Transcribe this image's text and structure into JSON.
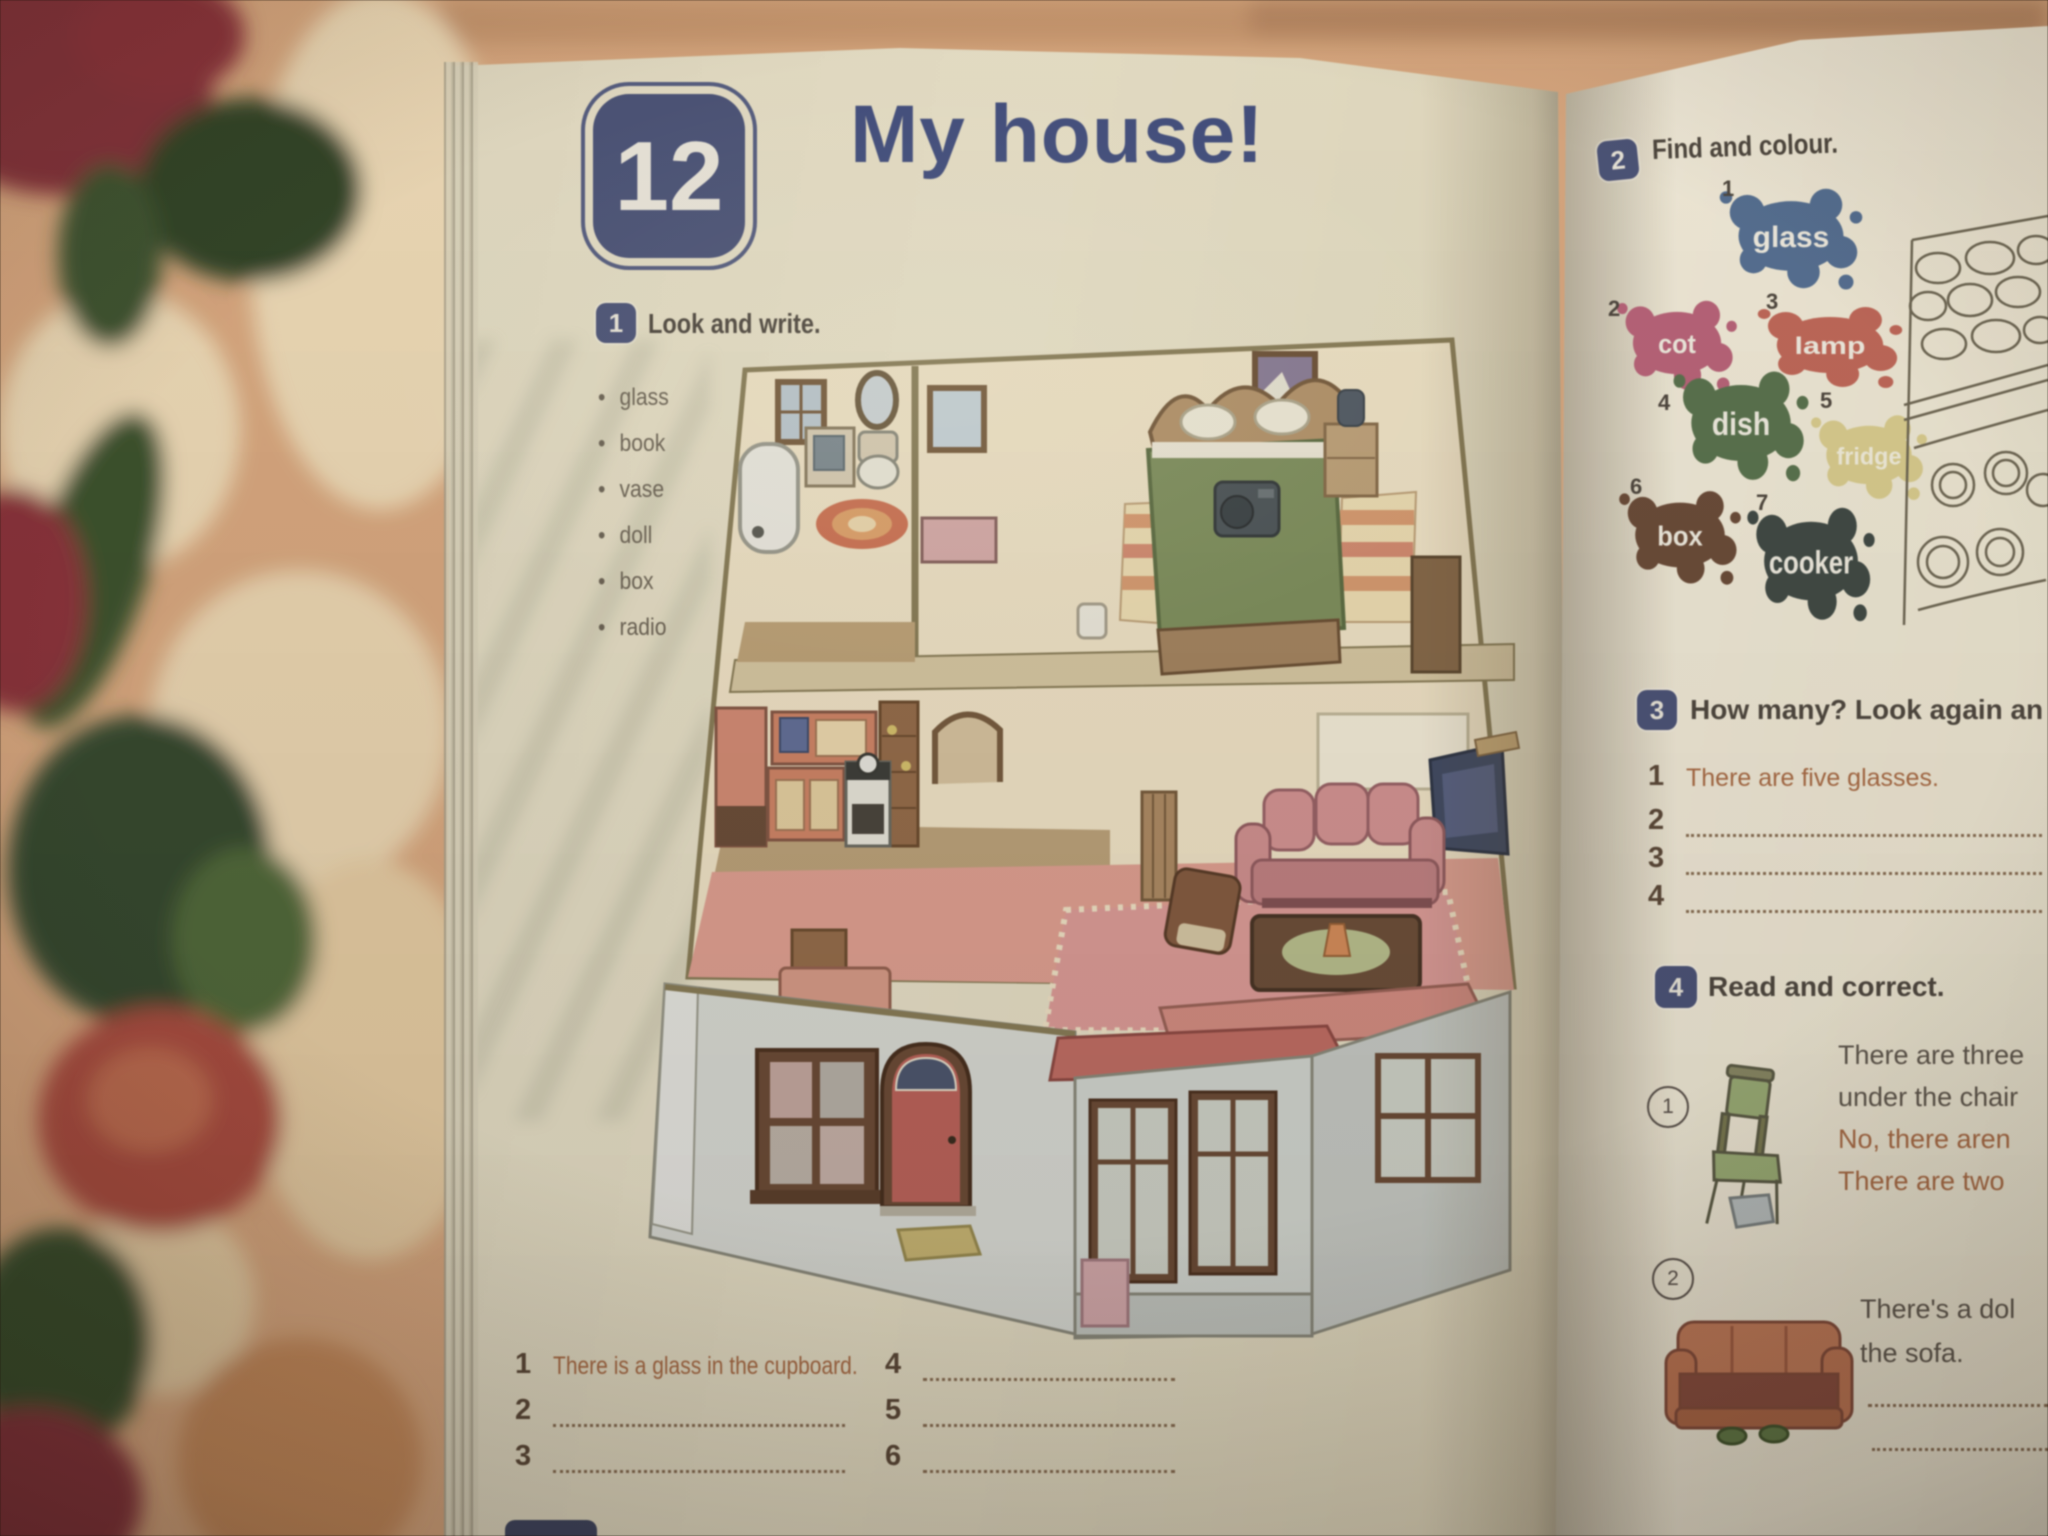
{
  "theme": {
    "badge_navy": "#49527e",
    "title_blue": "#3f4d86",
    "header_text": "#4e463c",
    "answer_orange": "#b2693c",
    "page_cream": "#e9e2c6"
  },
  "left_page": {
    "unit_badge": "12",
    "title": "My house!",
    "exercise1": {
      "badge": "1",
      "instruction": "Look and write.",
      "words": [
        "glass",
        "book",
        "vase",
        "doll",
        "box",
        "radio"
      ],
      "answer_rows": [
        {
          "num": "1",
          "text": "There is a glass in the cupboard."
        },
        {
          "num": "2",
          "text": ""
        },
        {
          "num": "3",
          "text": ""
        },
        {
          "num": "4",
          "text": ""
        },
        {
          "num": "5",
          "text": ""
        },
        {
          "num": "6",
          "text": ""
        }
      ]
    }
  },
  "right_page": {
    "exercise2": {
      "badge": "2",
      "instruction": "Find and colour.",
      "splats": [
        {
          "num": "1",
          "label": "glass",
          "color": "#51709a"
        },
        {
          "num": "2",
          "label": "cot",
          "color": "#c4607a"
        },
        {
          "num": "3",
          "label": "lamp",
          "color": "#cd6553"
        },
        {
          "num": "4",
          "label": "dish",
          "color": "#567449"
        },
        {
          "num": "5",
          "label": "fridge",
          "color": "#ddcf86"
        },
        {
          "num": "6",
          "label": "box",
          "color": "#6f4a33"
        },
        {
          "num": "7",
          "label": "cooker",
          "color": "#3e4a44"
        }
      ]
    },
    "exercise3": {
      "badge": "3",
      "instruction": "How many? Look again an",
      "rows": [
        {
          "num": "1",
          "text": "There are five glasses."
        },
        {
          "num": "2",
          "text": ""
        },
        {
          "num": "3",
          "text": ""
        },
        {
          "num": "4",
          "text": ""
        }
      ]
    },
    "exercise4": {
      "badge": "4",
      "instruction": "Read and correct.",
      "item1": {
        "num": "1",
        "line1": "There are three",
        "line2": "under the chair",
        "answer1": "No, there aren",
        "answer2": "There are two"
      },
      "item2": {
        "num": "2",
        "line1": "There's a dol",
        "line2": "the sofa."
      }
    }
  }
}
